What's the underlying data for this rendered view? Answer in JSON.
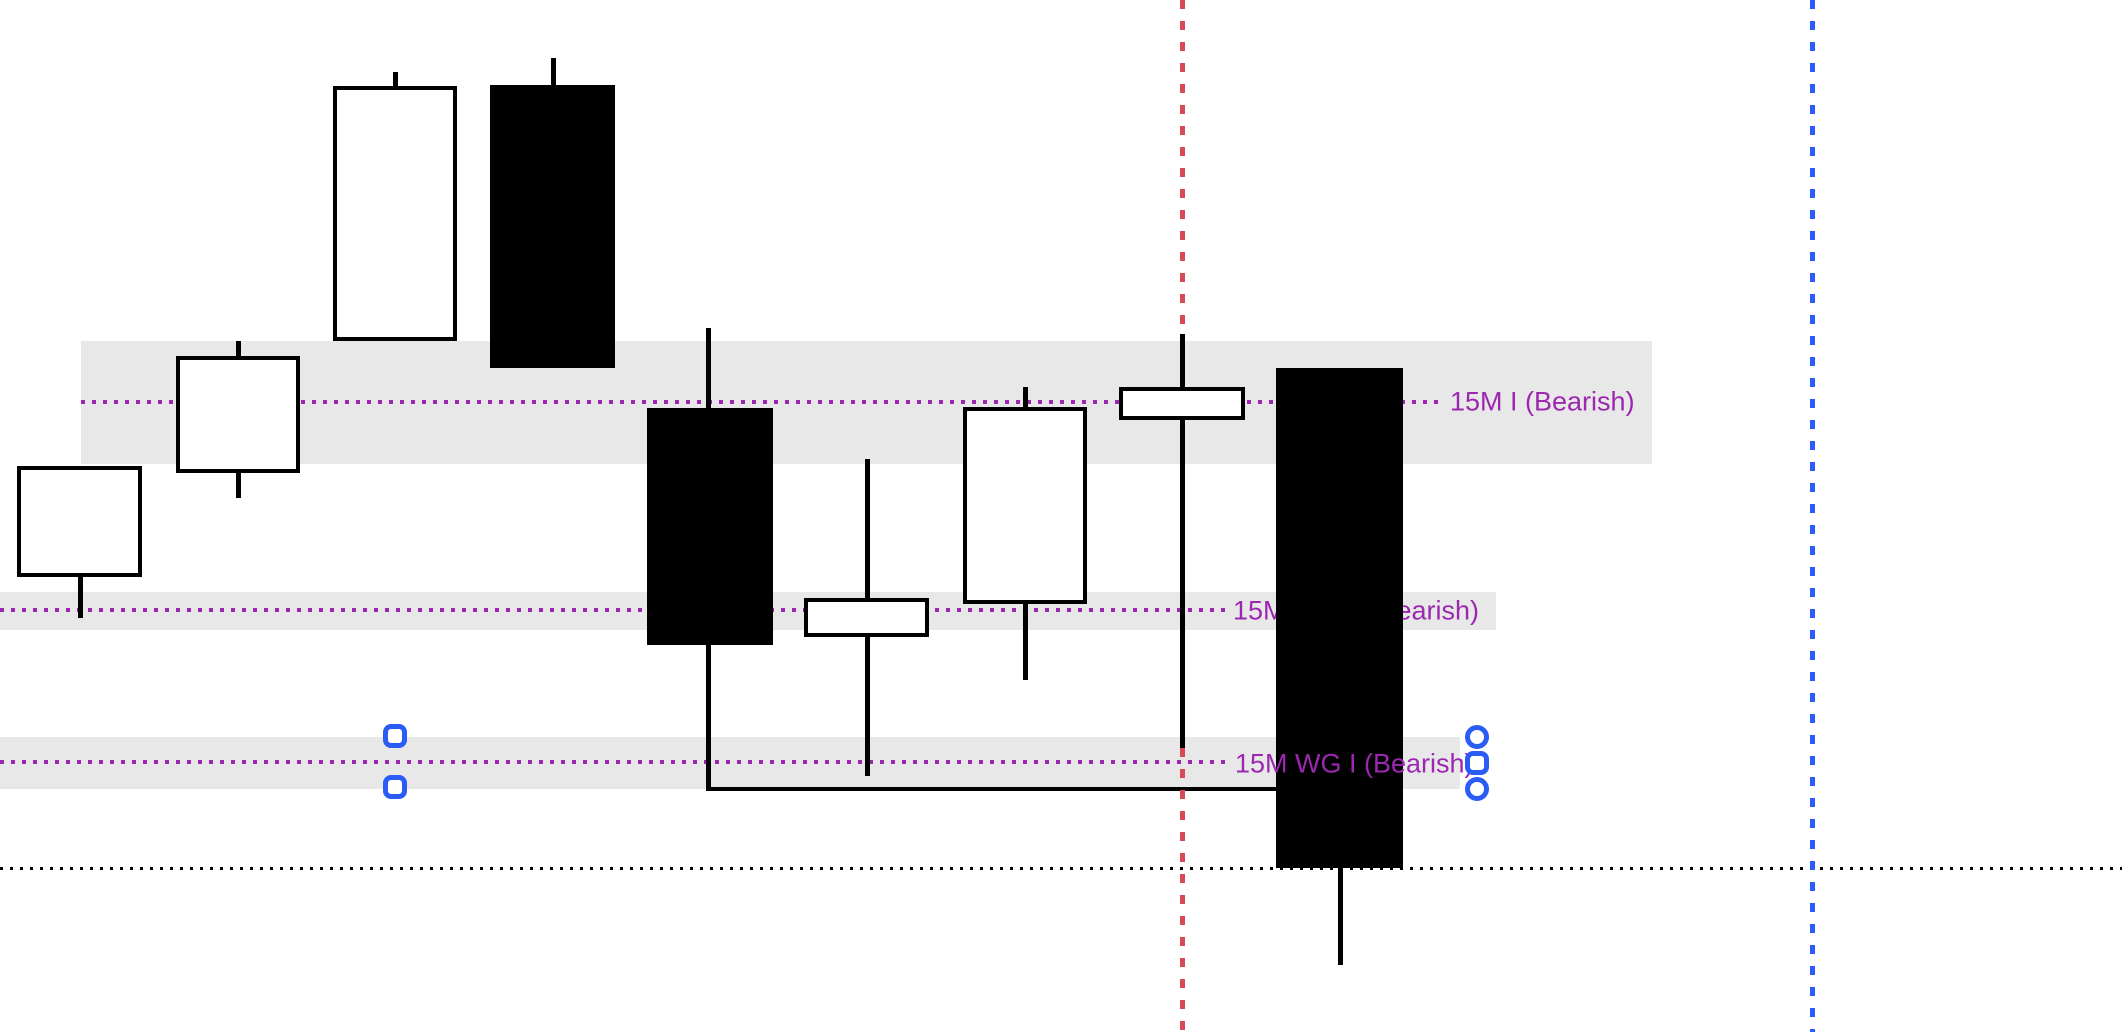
{
  "chart_data": {
    "type": "candlestick",
    "title": "",
    "axes_visible": false,
    "grid": false,
    "legend": false,
    "canvas": {
      "width": 2122,
      "height": 1032,
      "background": "#ffffff"
    },
    "colors": {
      "bullish_fill": "#ffffff",
      "bearish_fill": "#000000",
      "candle_border": "#000000",
      "zone_fill": "#e8e8e8",
      "zone_dotted_line": "#9c27b0",
      "label_text": "#9c27b0",
      "session_line_red": "#d84a55",
      "session_line_blue": "#2e5bff",
      "baseline_dotted": "#000000",
      "handle_stroke": "#2b5cf6"
    },
    "zones": [
      {
        "x": 81,
        "y": 341,
        "w": 1571,
        "h": 123,
        "line_y": 402,
        "line_x1": 81,
        "line_x2": 1443,
        "label": {
          "text": "15M I (Bearish)",
          "x": 1450,
          "y": 402,
          "layer": "above"
        }
      },
      {
        "x": 0,
        "y": 592,
        "w": 1496,
        "h": 38,
        "line_y": 610,
        "line_x1": 0,
        "line_x2": 1228,
        "label": {
          "text": "15M WG II (Bearish)",
          "x": 1233,
          "y": 611,
          "layer": "below"
        }
      },
      {
        "x": 0,
        "y": 737,
        "w": 1460,
        "h": 52,
        "line_y": 762,
        "line_x1": 0,
        "line_x2": 1230,
        "label": {
          "text": "15M WG I (Bearish)",
          "x": 1235,
          "y": 764,
          "layer": "above"
        }
      }
    ],
    "candles": [
      {
        "dir": "bull",
        "body": {
          "x": 17,
          "y": 466,
          "w": 125,
          "h": 111
        },
        "wicks": [
          {
            "x": 78,
            "y": 577,
            "h": 41
          }
        ]
      },
      {
        "dir": "bull",
        "body": {
          "x": 176,
          "y": 356,
          "w": 124,
          "h": 117
        },
        "wicks": [
          {
            "x": 236,
            "y": 341,
            "h": 15
          },
          {
            "x": 236,
            "y": 473,
            "h": 25
          }
        ]
      },
      {
        "dir": "bull",
        "body": {
          "x": 333,
          "y": 86,
          "w": 124,
          "h": 255
        },
        "wicks": [
          {
            "x": 393,
            "y": 72,
            "h": 14
          }
        ]
      },
      {
        "dir": "bear",
        "body": {
          "x": 490,
          "y": 85,
          "w": 125,
          "h": 283
        },
        "wicks": [
          {
            "x": 551,
            "y": 58,
            "h": 27
          }
        ]
      },
      {
        "dir": "bear",
        "body": {
          "x": 647,
          "y": 408,
          "w": 126,
          "h": 237
        },
        "wicks": [
          {
            "x": 706,
            "y": 328,
            "h": 80
          },
          {
            "x": 706,
            "y": 645,
            "h": 146
          }
        ]
      },
      {
        "dir": "bull",
        "body": {
          "x": 804,
          "y": 598,
          "w": 125,
          "h": 39
        },
        "wicks": [
          {
            "x": 865,
            "y": 459,
            "h": 139
          },
          {
            "x": 865,
            "y": 637,
            "h": 139
          }
        ]
      },
      {
        "dir": "bull",
        "body": {
          "x": 963,
          "y": 407,
          "w": 124,
          "h": 197
        },
        "wicks": [
          {
            "x": 1023,
            "y": 387,
            "h": 20
          },
          {
            "x": 1023,
            "y": 604,
            "h": 76
          }
        ]
      },
      {
        "dir": "bull",
        "body": {
          "x": 1119,
          "y": 387,
          "w": 126,
          "h": 33
        },
        "wicks": [
          {
            "x": 1180,
            "y": 334,
            "h": 53
          },
          {
            "x": 1180,
            "y": 420,
            "h": 328
          }
        ]
      },
      {
        "dir": "bear",
        "body": {
          "x": 1276,
          "y": 368,
          "w": 127,
          "h": 500
        },
        "wicks": [
          {
            "x": 1338,
            "y": 868,
            "h": 97
          }
        ]
      }
    ],
    "vlines": [
      {
        "name": "red",
        "color": "#d84a55",
        "x": 1182,
        "style": "dashed",
        "segments": [
          [
            0,
            333
          ],
          [
            748,
            1032
          ]
        ]
      },
      {
        "name": "blue",
        "color": "#2e5bff",
        "x": 1812,
        "style": "dashed",
        "segments": [
          [
            0,
            1032
          ]
        ]
      }
    ],
    "baseline": {
      "y": 867,
      "x1": 0,
      "x2": 2122,
      "style": "dotted",
      "color": "#000000"
    },
    "wick_gap_line": {
      "x1": 708,
      "x2": 1276,
      "y": 787,
      "color": "#000000"
    },
    "handles": [
      {
        "shape": "square",
        "cx": 395,
        "cy": 736
      },
      {
        "shape": "square",
        "cx": 395,
        "cy": 787
      },
      {
        "shape": "circle",
        "cx": 1477,
        "cy": 737
      },
      {
        "shape": "square",
        "cx": 1477,
        "cy": 763
      },
      {
        "shape": "circle",
        "cx": 1477,
        "cy": 789
      }
    ]
  }
}
